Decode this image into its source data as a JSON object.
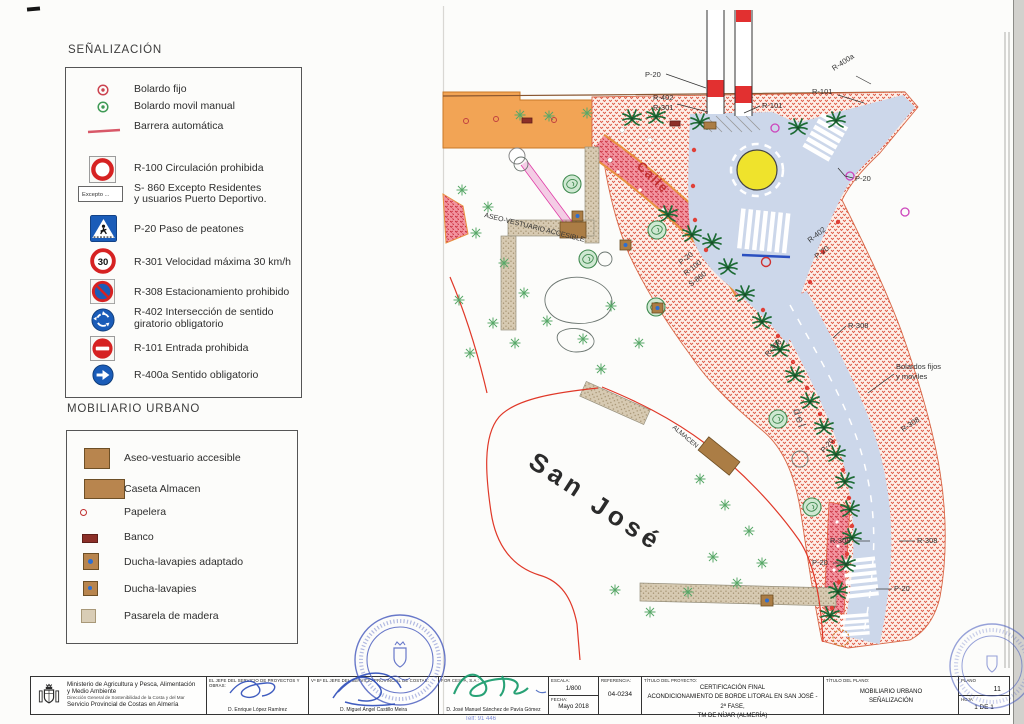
{
  "sheet": {
    "drawing_type": "site plan",
    "location": "San José, Níjar (Almería)"
  },
  "legend_signage": {
    "title": "SEÑALIZACIÓN",
    "items": [
      {
        "name": "bolardo-fijo",
        "label": "Bolardo fijo"
      },
      {
        "name": "bolardo-movil",
        "label": "Bolardo movil manual"
      },
      {
        "name": "barrera-automatica",
        "label": "Barrera automática"
      },
      {
        "name": "r-100",
        "label": "R-100 Circulación prohibida"
      },
      {
        "name": "s-860",
        "label": "S- 860 Excepto Residentes",
        "label2": "y usuarios Puerto Deportivo.",
        "sign_text": "Excepto ..."
      },
      {
        "name": "p-20",
        "label": "P-20 Paso de peatones"
      },
      {
        "name": "r-301",
        "label": "R-301 Velocidad máxima 30 km/h",
        "sign_text": "30"
      },
      {
        "name": "r-308",
        "label": "R-308 Estacionamiento prohibido"
      },
      {
        "name": "r-402",
        "label": "R-402 Intersección de sentido",
        "label2": "giratorio obligatorio"
      },
      {
        "name": "r-101",
        "label": "R-101 Entrada prohibida"
      },
      {
        "name": "r-400a",
        "label": "R-400a Sentido obligatorio"
      }
    ]
  },
  "legend_furniture": {
    "title": "MOBILIARIO URBANO",
    "items": [
      {
        "name": "aseo-vestuario",
        "label": "Aseo-vestuario accesible"
      },
      {
        "name": "caseta-almacen",
        "label": "Caseta Almacen"
      },
      {
        "name": "papelera",
        "label": "Papelera"
      },
      {
        "name": "banco",
        "label": "Banco"
      },
      {
        "name": "ducha-lavapies-adaptado",
        "label": "Ducha-lavapies adaptado"
      },
      {
        "name": "ducha-lavapies",
        "label": "Ducha-lavapies"
      },
      {
        "name": "pasarela-madera",
        "label": "Pasarela de madera"
      }
    ]
  },
  "map": {
    "annotations": [
      {
        "text": "P-20",
        "x": 645,
        "y": 77
      },
      {
        "text": "R-402",
        "x": 653,
        "y": 100
      },
      {
        "text": "R-301",
        "x": 653,
        "y": 110
      },
      {
        "text": "R-101",
        "x": 762,
        "y": 108
      },
      {
        "text": "R-400a",
        "x": 834,
        "y": 71,
        "rot": -33
      },
      {
        "text": "R-101",
        "x": 812,
        "y": 94
      },
      {
        "text": "P-20",
        "x": 855,
        "y": 181
      },
      {
        "text": "R-402",
        "x": 810,
        "y": 243,
        "rot": -38
      },
      {
        "text": "P-20",
        "x": 817,
        "y": 259,
        "rot": -38
      },
      {
        "text": "P-20",
        "x": 681,
        "y": 265,
        "rot": -38
      },
      {
        "text": "R-100",
        "x": 686,
        "y": 276,
        "rot": -38
      },
      {
        "text": "S-860",
        "x": 691,
        "y": 287,
        "rot": -38
      },
      {
        "text": "R-308",
        "x": 848,
        "y": 328
      },
      {
        "text": "Bolardos fijos",
        "x": 896,
        "y": 369
      },
      {
        "text": "y moviles",
        "x": 896,
        "y": 379
      },
      {
        "text": "R-308",
        "x": 903,
        "y": 432,
        "rot": -33
      },
      {
        "text": "R-308",
        "x": 768,
        "y": 357,
        "rot": -47
      },
      {
        "text": "P-20",
        "x": 824,
        "y": 453,
        "rot": -50
      },
      {
        "text": "R-308",
        "x": 830,
        "y": 543
      },
      {
        "text": "R-308",
        "x": 917,
        "y": 543
      },
      {
        "text": "P-20",
        "x": 812,
        "y": 565
      },
      {
        "text": "P-20",
        "x": 894,
        "y": 591
      },
      {
        "text": "Calle",
        "x": 636,
        "y": 167,
        "rot": 44,
        "size": 13,
        "color": "#c23030",
        "spacing": 1.5,
        "bold": true
      },
      {
        "text": "del",
        "x": 793,
        "y": 410,
        "rot": 72,
        "size": 11,
        "color": "#555555",
        "spacing": 2
      },
      {
        "text": "San",
        "x": 527,
        "y": 466,
        "rot": 33,
        "size": 26,
        "color": "#2b2b2b",
        "spacing": 5,
        "bold": true
      },
      {
        "text": "José",
        "x": 589,
        "y": 509,
        "rot": 33,
        "size": 26,
        "color": "#2b2b2b",
        "spacing": 5,
        "bold": true
      },
      {
        "text": "ALMACEN",
        "x": 672,
        "y": 428,
        "rot": 40,
        "size": 6.5
      },
      {
        "text": "ASEO-VESTUARIO ACCESIBLE",
        "x": 484,
        "y": 217,
        "rot": 14,
        "size": 7
      }
    ]
  },
  "title_block": {
    "ministry": {
      "line1": "Ministerio de Agricultura y Pesca, Alimentación",
      "line2": "y Medio Ambiente",
      "line3": "Dirección General de Sostenibilidad de la Costa y del Mar",
      "line4": "Servicio Provincial de Costas en Almería"
    },
    "proyectos": {
      "header": "EL JEFE DEL SERVICIO DE PROYECTOS Y OBRAS:",
      "name": "D. Enrique López Ramírez"
    },
    "provincial": {
      "header": "Vº Bº EL JEFE DEL SERVICIO PROVINCIAL DE COSTAS:",
      "name": "D. Miguel Ángel Castillo Meira"
    },
    "cespa": {
      "header": "POR CESPA, S.A.:",
      "name": "D. José Manuel Sánchez de Pavía Gómez",
      "phone_fragment": "Telf: 91 446"
    },
    "escala": {
      "label": "ESCALA:",
      "value": "1/800"
    },
    "fecha": {
      "label": "FECHA:",
      "value": "Mayo 2018"
    },
    "referencia": {
      "label": "REFERENCIA:",
      "value": "04-0234"
    },
    "proyecto": {
      "label": "TÍTULO DEL PROYECTO:",
      "line1": "CERTIFICACIÓN FINAL",
      "line2": "ACONDICIONAMIENTO DE BORDE LITORAL EN SAN JOSÉ - 2ª FASE,",
      "line3": "TM DE NÍJAR (ALMERÍA)"
    },
    "plano": {
      "label": "TÍTULO DEL PLANO:",
      "line1": "MOBILIARIO URBANO",
      "line2": "SEÑALIZACIÓN"
    },
    "plano_num": {
      "label": "PLANO",
      "value": "11"
    },
    "hoja": {
      "label": "HOJA",
      "value": "1 DE 1"
    }
  },
  "colors": {
    "hatch_red": "#dd5440",
    "dense_band": "#f2939e",
    "road_blue": "#ccd7ea",
    "orange_strip": "#f2a455",
    "palm_green": "#1d6b35",
    "roundabout_yellow": "#efe32c",
    "boundary_red": "#e03828",
    "stamp_blue": "#4458bd",
    "signature_blue": "#2a4ab8",
    "signature_green": "#169a6a",
    "furniture_brown": "#ab7d45"
  }
}
